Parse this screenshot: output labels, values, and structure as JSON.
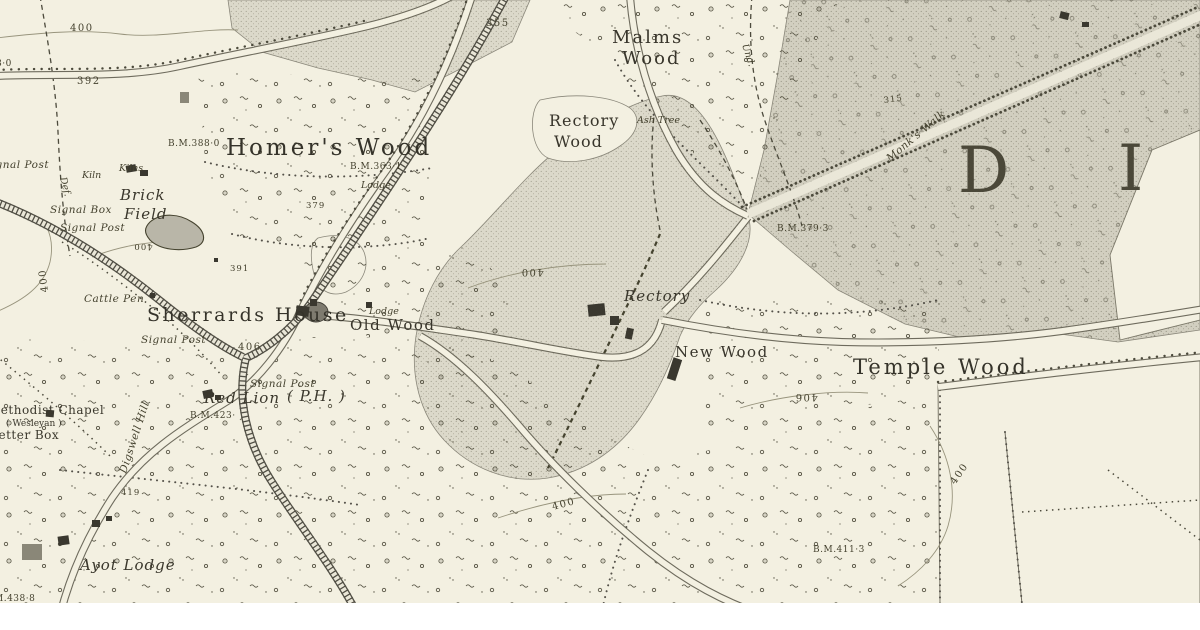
{
  "colors": {
    "paper": "#f3f0e1",
    "ink": "#3a382f",
    "wood_light": "#dcd9ca",
    "wood_dark": "#d2cfc0",
    "white_margin": "#ffffff"
  },
  "district_letters": {
    "first": "D",
    "second": "I"
  },
  "place_labels": {
    "homers_wood": "Homer's Wood",
    "malms_line1": "Malms",
    "malms_line2": "Wood",
    "rectory_wood_line1": "Rectory",
    "rectory_wood_line2": "Wood",
    "temple_wood": "Temple Wood",
    "new_wood": "New Wood",
    "old_wood": "Old Wood",
    "sherrards_house": "Sherrards House",
    "rectory": "Rectory",
    "brick_line1": "Brick",
    "brick_line2": "Field",
    "ayot_lodge": "Ayot Lodge",
    "red_lion": "Red Lion",
    "red_lion_ph": "( P.H. )",
    "methodist_chapel": "Methodist Chapel",
    "wesleyan": "( Wesleyan )",
    "letter_box": "Letter Box",
    "monks_walk": "Monk's Walk",
    "digswell_hill": "Digswell Hill"
  },
  "feature_labels": {
    "cattle_pen": "Cattle Pen",
    "signal_post_nw": "Signal Post",
    "signal_box": "Signal Box",
    "signal_post_w": "Signal Post",
    "signal_post_mid": "Signal Post",
    "signal_post_s": "Signal Post",
    "kiln": "Kiln",
    "kilns": "Kilns",
    "lodge_north": "Lodge",
    "lodge_old_wood": "Lodge",
    "ash_tree": "Ash Tree",
    "def_boundary": "Def.",
    "und_boundary": "Und."
  },
  "benchmarks": {
    "bm_388_0": "B.M.388·0",
    "bm_363_1": "B.M.363·1",
    "bm_379_3": "B.M.379·3",
    "bm_423": "B.M.423·",
    "bm_411_3": "B.M.411·3",
    "bm_438_8": "M.438·8",
    "bm_partial_nw": "8·0"
  },
  "spot_heights": {
    "h400_nw": "400",
    "h392": "392",
    "h355": "355",
    "h315": "315",
    "h379": "379",
    "h400_brick": "400",
    "h400_left": "400",
    "h391": "391",
    "h406_junction": "406",
    "h400_rectory": "400",
    "h406_temple": "406",
    "h400_south": "400",
    "h400_se": "400",
    "h419": "419"
  }
}
